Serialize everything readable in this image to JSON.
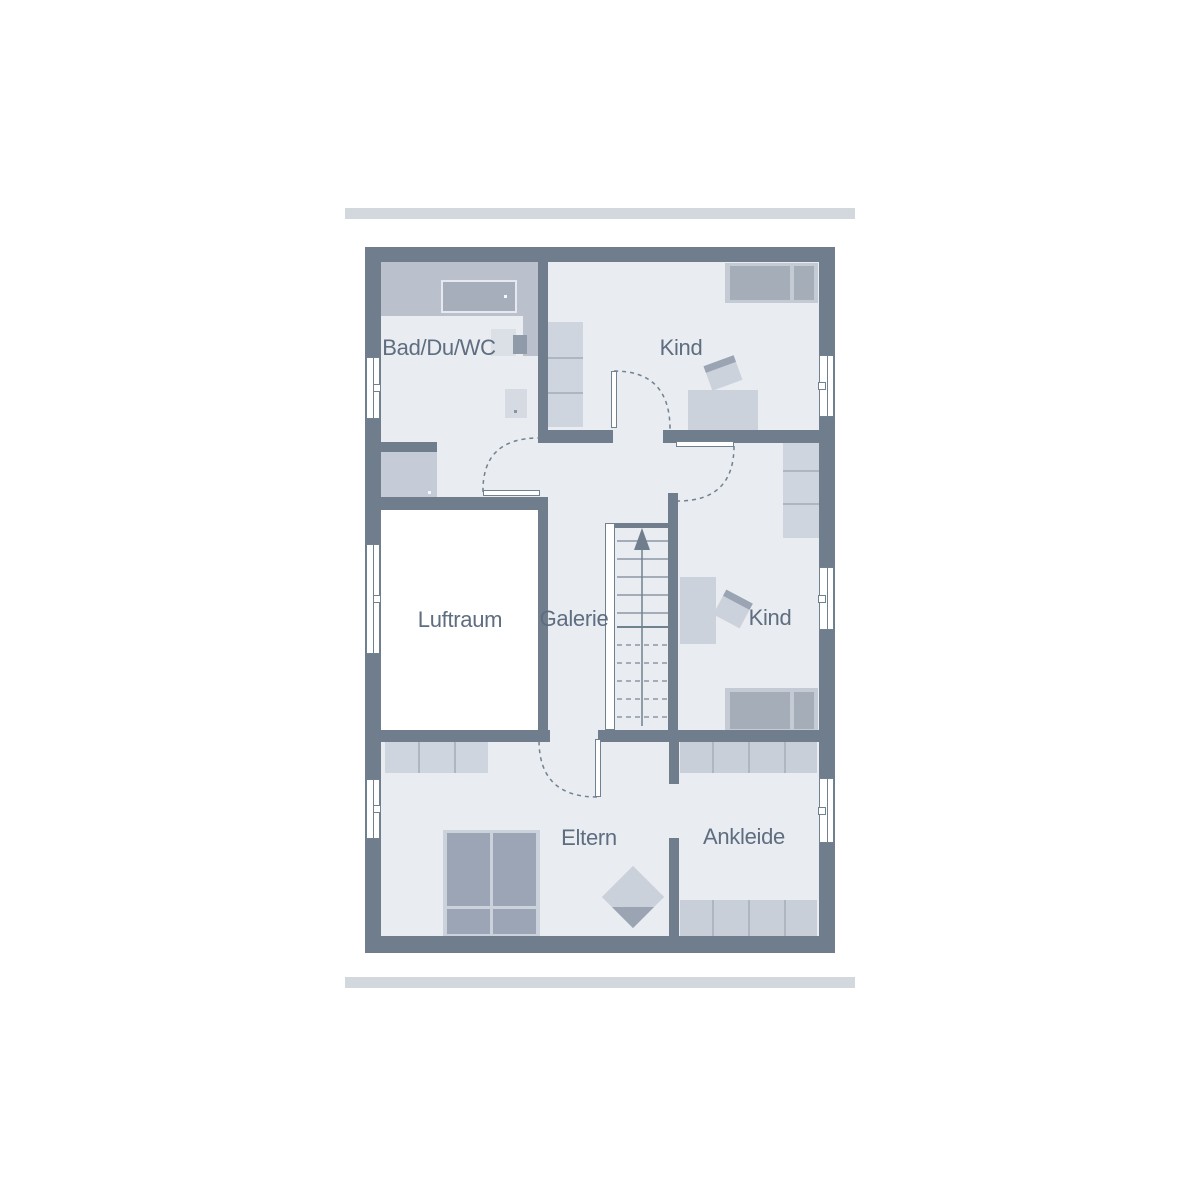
{
  "rooms": [
    {
      "id": "bathroom",
      "label": "Bad/Du/WC"
    },
    {
      "id": "child-room-top",
      "label": "Kind"
    },
    {
      "id": "air-space",
      "label": "Luftraum"
    },
    {
      "id": "gallery",
      "label": "Galerie"
    },
    {
      "id": "child-room-middle",
      "label": "Kind"
    },
    {
      "id": "parents-room",
      "label": "Eltern"
    },
    {
      "id": "dressing-room",
      "label": "Ankleide"
    }
  ],
  "stairs": {
    "direction": "up"
  },
  "palette": {
    "wall": "#707d8d",
    "floor": "#e9ecf1",
    "air_space_void": "#ffffff",
    "furniture_light": "#cfd5de",
    "furniture_medium": "#a5adb9",
    "counter_band": "#bac1cc",
    "roof_edge_bar": "#d3d7de",
    "label_text": "#5e6d7f"
  }
}
